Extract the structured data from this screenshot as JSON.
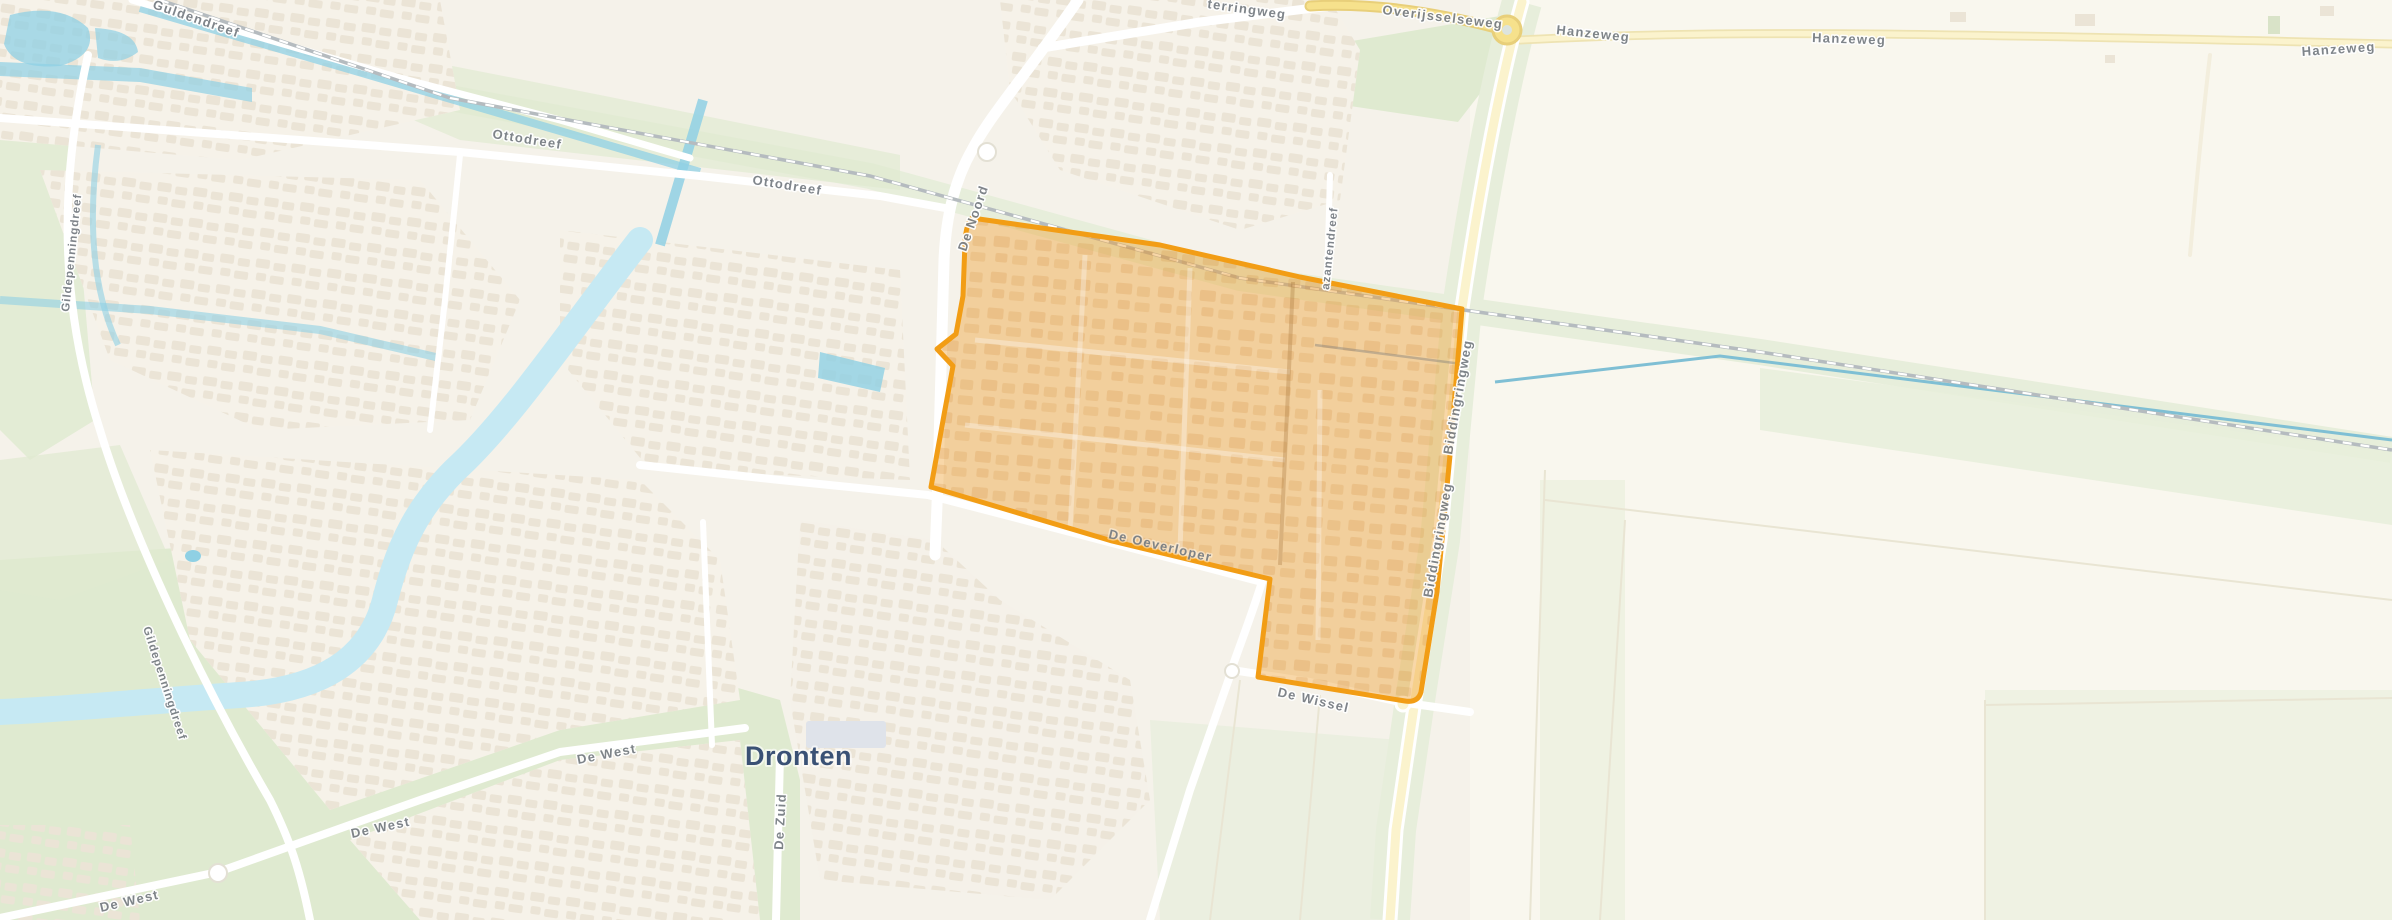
{
  "map": {
    "town": "Dronten",
    "street_labels": {
      "guldendreef": "Guldendreef",
      "ottodreef": "Ottodreef",
      "de_noord": "De Noord",
      "dronterringweg_partial": "terringweg",
      "overijsselseweg": "Overijsselseweg",
      "hanzeweg": "Hanzeweg",
      "biddingringweg": "Biddingringweg",
      "fazantendreef_partial": "azantendreef",
      "de_oeverloper": "De Oeverloper",
      "de_wissel": "De Wissel",
      "de_west": "De West",
      "de_zuid": "De Zuid",
      "gildepenningdreef": "Gildepenningdreef"
    }
  },
  "colors": {
    "land": "#f5f2ea",
    "farmland": "#faf7ee",
    "water_canal": "#8fd0e4",
    "water_river": "#c6e9f3",
    "green": "#dfead0",
    "green_light": "#e7eedb",
    "road_white": "#ffffff",
    "road_yellow": "#f6e18c",
    "road_yellow_casing": "#e8cf7a",
    "road_yellow_pale": "#fbf3cd",
    "road_yellow_pale_casing": "#eee3b2",
    "railway": "#b5bbbf",
    "building": "#ebe4d6",
    "building_grey": "#dfe3ea",
    "highlight_fill": "#ef9f30",
    "highlight_stroke": "#f29d15",
    "label_grey": "#797f85",
    "town_label": "#3a5175"
  }
}
